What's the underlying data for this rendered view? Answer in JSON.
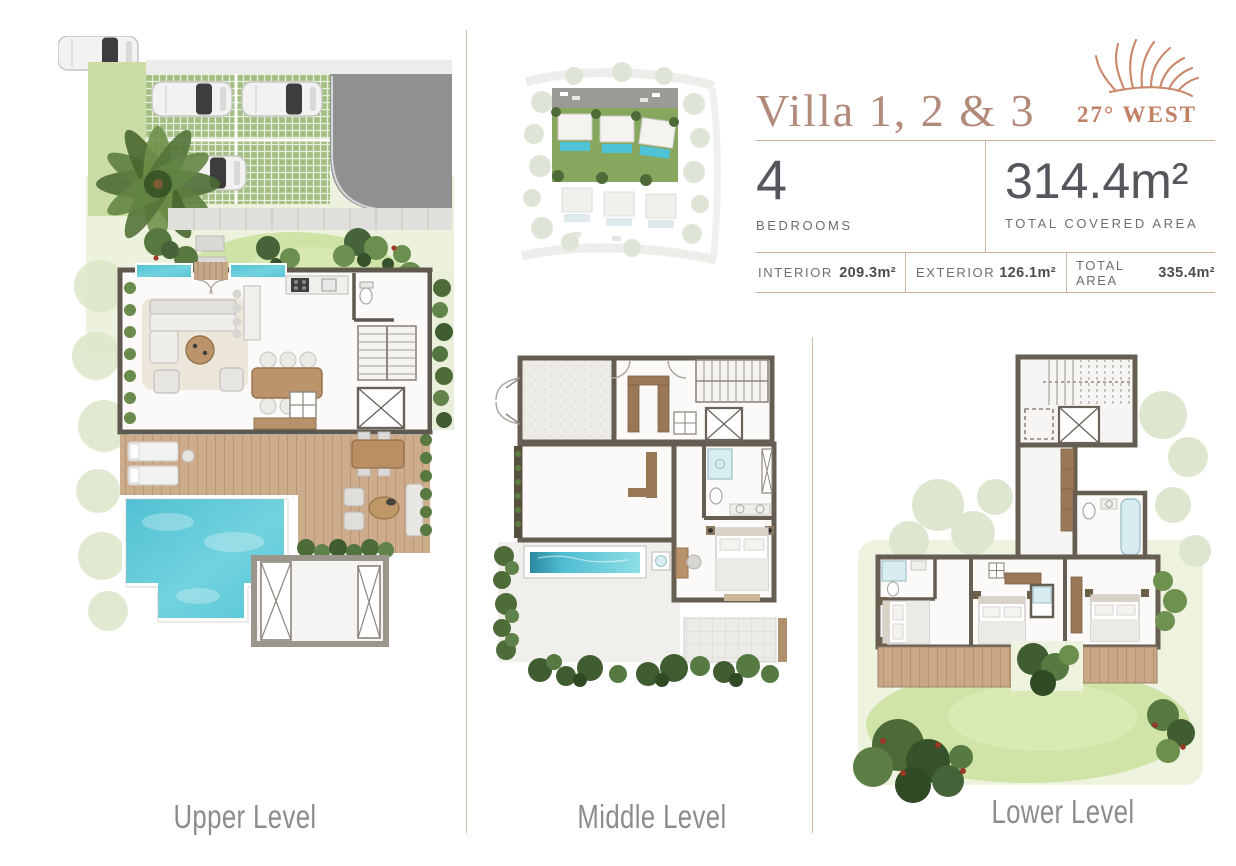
{
  "header": {
    "title": "Villa 1, 2 & 3",
    "brand": {
      "name": "27° WEST",
      "icon": "palm-frond-icon",
      "color": "#c28064"
    },
    "bedrooms": {
      "value": "4",
      "label": "BEDROOMS"
    },
    "total_covered": {
      "value": "314.4m²",
      "label": "TOTAL COVERED AREA"
    },
    "area_stats": [
      {
        "label": "INTERIOR",
        "value": "209.3m²"
      },
      {
        "label": "EXTERIOR",
        "value": "126.1m²"
      },
      {
        "label": "TOTAL AREA",
        "value": "335.4m²"
      }
    ]
  },
  "levels": [
    {
      "id": "upper",
      "label": "Upper Level"
    },
    {
      "id": "middle",
      "label": "Middle Level"
    },
    {
      "id": "lower",
      "label": "Lower Level"
    }
  ],
  "site_plan": {
    "highlighted_villas": 3,
    "total_villas": 6
  },
  "palette": {
    "accent": "#b28a7a",
    "divider": "#cdb6a2",
    "pool": "#5ec9d8",
    "lawn": "#cfe3a6",
    "wood": "#c2a181",
    "wall": "#5f584e",
    "text_dark": "#55575c",
    "text_gray": "#6d6e71",
    "label_gray": "#8c8c8c"
  }
}
